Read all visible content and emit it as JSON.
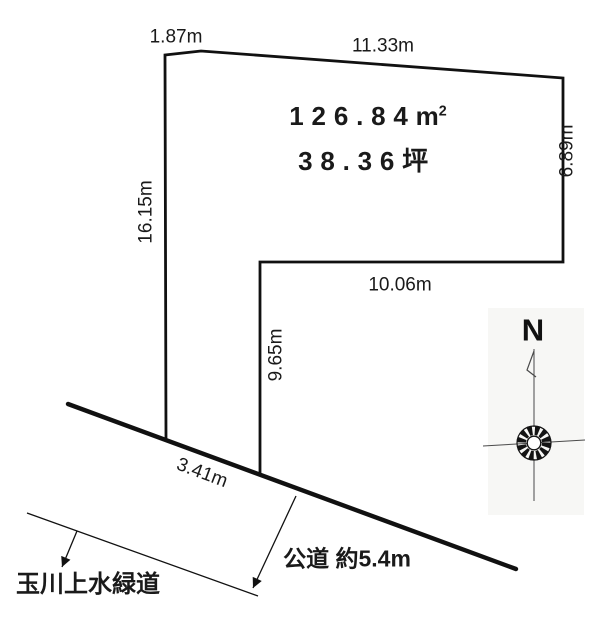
{
  "diagram": {
    "title_area": {
      "sqm_value": "126.84",
      "sqm_unit_base": "m",
      "sqm_unit_sup": "2",
      "tsubo": "38.36坪"
    },
    "dims": {
      "top_left": "1.87m",
      "top": "11.33m",
      "right": "6.89m",
      "left": "16.15m",
      "step_bottom": "10.06m",
      "step_side": "9.65m",
      "frontage": "3.41m"
    },
    "road_label": "公道 約5.4m",
    "greenway_label": "玉川上水緑道",
    "compass_north": "N",
    "colors": {
      "line": "#111111",
      "background": "#ffffff",
      "compass_scan_bg": "#f7f7f5",
      "compass_line": "#4a4a4a"
    }
  }
}
